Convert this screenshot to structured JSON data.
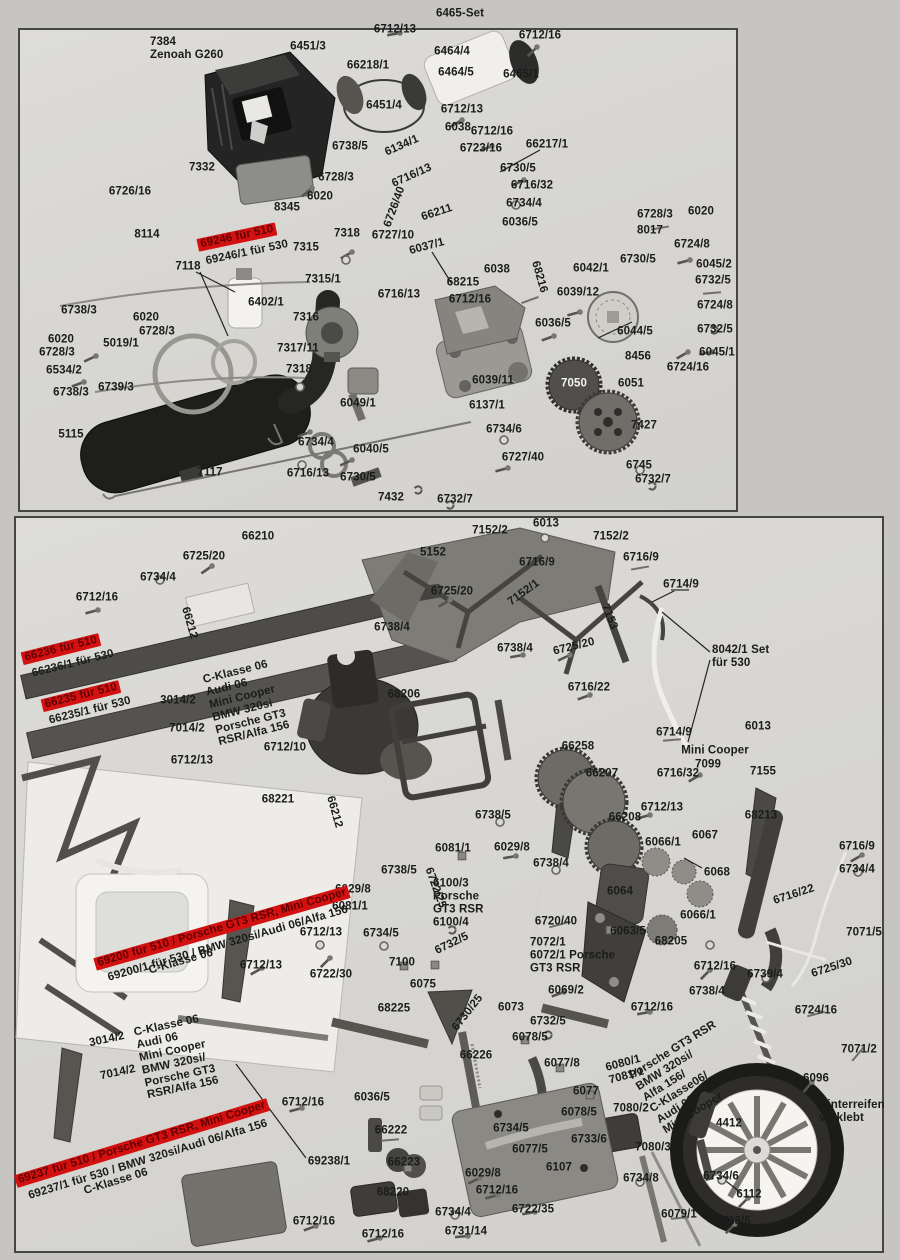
{
  "colors": {
    "highlight_band": "#d41111",
    "ink": "#1b1b1b",
    "panel_bg": "#d7d6d2"
  },
  "panels": [
    {
      "id": "engine-assembly",
      "note": "engine / exhaust / clutch exploded view"
    },
    {
      "id": "chassis-assembly",
      "note": "chassis / drivetrain / wheel exploded view"
    }
  ],
  "labels": [
    {
      "t": "6465-Set",
      "x": 460,
      "y": 14
    },
    {
      "t": "6712/13",
      "x": 395,
      "y": 30
    },
    {
      "t": "6712/16",
      "x": 540,
      "y": 36
    },
    {
      "t": "7384\nZenoah G260",
      "x": 150,
      "y": 49,
      "ta": 1
    },
    {
      "t": "6451/3",
      "x": 308,
      "y": 47
    },
    {
      "t": "6464/4",
      "x": 452,
      "y": 52
    },
    {
      "t": "66218/1",
      "x": 368,
      "y": 66
    },
    {
      "t": "6464/5",
      "x": 456,
      "y": 73
    },
    {
      "t": "6465/1",
      "x": 521,
      "y": 75
    },
    {
      "t": "6451/4",
      "x": 384,
      "y": 106
    },
    {
      "t": "6712/13",
      "x": 462,
      "y": 110
    },
    {
      "t": "6038",
      "x": 458,
      "y": 128
    },
    {
      "t": "6712/16",
      "x": 492,
      "y": 132
    },
    {
      "t": "6723/16",
      "x": 481,
      "y": 149
    },
    {
      "t": "66217/1",
      "x": 547,
      "y": 145
    },
    {
      "t": "6738/5",
      "x": 350,
      "y": 147
    },
    {
      "t": "6134/1",
      "x": 402,
      "y": 146,
      "r": -24
    },
    {
      "t": "6730/5",
      "x": 518,
      "y": 169
    },
    {
      "t": "6716/32",
      "x": 532,
      "y": 186
    },
    {
      "t": "6716/13",
      "x": 412,
      "y": 176,
      "r": -24
    },
    {
      "t": "6726/16",
      "x": 130,
      "y": 192
    },
    {
      "t": "7332",
      "x": 202,
      "y": 168
    },
    {
      "t": "6728/3",
      "x": 336,
      "y": 178
    },
    {
      "t": "6020",
      "x": 320,
      "y": 197
    },
    {
      "t": "6734/4",
      "x": 524,
      "y": 204
    },
    {
      "t": "8345",
      "x": 287,
      "y": 208
    },
    {
      "t": "6726/40",
      "x": 395,
      "y": 207,
      "r": -70
    },
    {
      "t": "66211",
      "x": 437,
      "y": 213,
      "r": -18
    },
    {
      "t": "6036/5",
      "x": 520,
      "y": 223
    },
    {
      "t": "6728/3",
      "x": 655,
      "y": 215
    },
    {
      "t": "6020",
      "x": 701,
      "y": 212
    },
    {
      "t": "8114",
      "x": 147,
      "y": 235
    },
    {
      "t": "8017",
      "x": 650,
      "y": 231
    },
    {
      "t": "6727/10",
      "x": 393,
      "y": 236
    },
    {
      "t": "6037/1",
      "x": 427,
      "y": 247,
      "r": -15
    },
    {
      "t": "6724/8",
      "x": 692,
      "y": 245
    },
    {
      "t": "7318",
      "x": 347,
      "y": 234
    },
    {
      "t": "7315",
      "x": 306,
      "y": 248
    },
    {
      "t": "69246 für 510",
      "x": 237,
      "y": 237,
      "r": -12,
      "hl": 1
    },
    {
      "t": "69246/1 für 530",
      "x": 247,
      "y": 253,
      "r": -12
    },
    {
      "t": "6730/5",
      "x": 638,
      "y": 260
    },
    {
      "t": "6045/2",
      "x": 714,
      "y": 265
    },
    {
      "t": "6042/1",
      "x": 591,
      "y": 269
    },
    {
      "t": "6732/5",
      "x": 713,
      "y": 281
    },
    {
      "t": "7315/1",
      "x": 323,
      "y": 280
    },
    {
      "t": "6038",
      "x": 497,
      "y": 270
    },
    {
      "t": "68215",
      "x": 463,
      "y": 283
    },
    {
      "t": "6716/13",
      "x": 399,
      "y": 295
    },
    {
      "t": "6712/16",
      "x": 470,
      "y": 300
    },
    {
      "t": "68216",
      "x": 539,
      "y": 277,
      "r": 74
    },
    {
      "t": "6039/12",
      "x": 578,
      "y": 293
    },
    {
      "t": "6724/8",
      "x": 715,
      "y": 306
    },
    {
      "t": "7118",
      "x": 188,
      "y": 267
    },
    {
      "t": "6402/1",
      "x": 266,
      "y": 303
    },
    {
      "t": "7316",
      "x": 306,
      "y": 318
    },
    {
      "t": "6020",
      "x": 146,
      "y": 318
    },
    {
      "t": "6728/3",
      "x": 157,
      "y": 332
    },
    {
      "t": "6738/3",
      "x": 79,
      "y": 311
    },
    {
      "t": "5019/1",
      "x": 121,
      "y": 344
    },
    {
      "t": "6036/5",
      "x": 553,
      "y": 324
    },
    {
      "t": "6732/5",
      "x": 715,
      "y": 330
    },
    {
      "t": "6020",
      "x": 61,
      "y": 340
    },
    {
      "t": "6728/3",
      "x": 57,
      "y": 353
    },
    {
      "t": "7317/11",
      "x": 298,
      "y": 349
    },
    {
      "t": "6044/5",
      "x": 635,
      "y": 332
    },
    {
      "t": "6534/2",
      "x": 64,
      "y": 371
    },
    {
      "t": "8456",
      "x": 638,
      "y": 357
    },
    {
      "t": "6045/1",
      "x": 717,
      "y": 353
    },
    {
      "t": "6739/3",
      "x": 116,
      "y": 388
    },
    {
      "t": "6738/3",
      "x": 71,
      "y": 393
    },
    {
      "t": "7318",
      "x": 299,
      "y": 370
    },
    {
      "t": "6724/16",
      "x": 688,
      "y": 368
    },
    {
      "t": "6039/11",
      "x": 493,
      "y": 381
    },
    {
      "t": "7050",
      "x": 574,
      "y": 384,
      "w": 1
    },
    {
      "t": "6051",
      "x": 631,
      "y": 384
    },
    {
      "t": "6049/1",
      "x": 358,
      "y": 404
    },
    {
      "t": "6137/1",
      "x": 487,
      "y": 406
    },
    {
      "t": "7427",
      "x": 644,
      "y": 426
    },
    {
      "t": "5115",
      "x": 71,
      "y": 435
    },
    {
      "t": "6734/4",
      "x": 316,
      "y": 443
    },
    {
      "t": "6734/6",
      "x": 504,
      "y": 430
    },
    {
      "t": "6040/5",
      "x": 371,
      "y": 450
    },
    {
      "t": "6727/40",
      "x": 523,
      "y": 458
    },
    {
      "t": "6716/13",
      "x": 308,
      "y": 474
    },
    {
      "t": "6730/5",
      "x": 358,
      "y": 478
    },
    {
      "t": "7117",
      "x": 210,
      "y": 473
    },
    {
      "t": "6745",
      "x": 639,
      "y": 466
    },
    {
      "t": "7432",
      "x": 391,
      "y": 498
    },
    {
      "t": "6732/7",
      "x": 455,
      "y": 500
    },
    {
      "t": "6732/7",
      "x": 653,
      "y": 480
    },
    {
      "t": "66210",
      "x": 258,
      "y": 537
    },
    {
      "t": "6725/20",
      "x": 204,
      "y": 557
    },
    {
      "t": "7152/2",
      "x": 490,
      "y": 531
    },
    {
      "t": "6013",
      "x": 546,
      "y": 524
    },
    {
      "t": "7152/2",
      "x": 611,
      "y": 537
    },
    {
      "t": "6734/4",
      "x": 158,
      "y": 578
    },
    {
      "t": "5152",
      "x": 433,
      "y": 553
    },
    {
      "t": "6716/9",
      "x": 537,
      "y": 563
    },
    {
      "t": "6716/9",
      "x": 641,
      "y": 558
    },
    {
      "t": "6712/16",
      "x": 97,
      "y": 598
    },
    {
      "t": "66212",
      "x": 189,
      "y": 623,
      "r": 74
    },
    {
      "t": "6725/20",
      "x": 452,
      "y": 592
    },
    {
      "t": "7152/1",
      "x": 524,
      "y": 593,
      "r": -36
    },
    {
      "t": "6714/9",
      "x": 681,
      "y": 585
    },
    {
      "t": "7153",
      "x": 609,
      "y": 617,
      "r": 68
    },
    {
      "t": "6738/4",
      "x": 392,
      "y": 628
    },
    {
      "t": "66236 für 510",
      "x": 61,
      "y": 649,
      "r": -14,
      "hl": 1
    },
    {
      "t": "66236/1 für 530",
      "x": 73,
      "y": 664,
      "r": -14
    },
    {
      "t": "6738/4",
      "x": 515,
      "y": 649
    },
    {
      "t": "6725/20",
      "x": 574,
      "y": 647,
      "r": -14
    },
    {
      "t": "8042/1 Set\nfür 530",
      "x": 712,
      "y": 657,
      "ta": 1
    },
    {
      "t": "C-Klasse 06\nAudi 06\nMini Cooper\nBMW 320si\nPorsche GT3\nRSR/Alfa 156",
      "x": 210,
      "y": 703,
      "r": -14,
      "ta": 1
    },
    {
      "t": "66235 für 510",
      "x": 81,
      "y": 696,
      "r": -14,
      "hl": 1
    },
    {
      "t": "66235/1 für 530",
      "x": 90,
      "y": 711,
      "r": -14
    },
    {
      "t": "3014/2",
      "x": 178,
      "y": 701
    },
    {
      "t": "68206",
      "x": 404,
      "y": 695
    },
    {
      "t": "6716/22",
      "x": 589,
      "y": 688
    },
    {
      "t": "7014/2",
      "x": 187,
      "y": 729
    },
    {
      "t": "6714/9",
      "x": 674,
      "y": 733
    },
    {
      "t": "6013",
      "x": 758,
      "y": 727
    },
    {
      "t": "6712/13",
      "x": 192,
      "y": 761
    },
    {
      "t": "6712/10",
      "x": 285,
      "y": 748
    },
    {
      "t": "66258",
      "x": 578,
      "y": 747
    },
    {
      "t": "Mini Cooper",
      "x": 715,
      "y": 751
    },
    {
      "t": "7099",
      "x": 708,
      "y": 765
    },
    {
      "t": "66207",
      "x": 602,
      "y": 774
    },
    {
      "t": "6716/32",
      "x": 678,
      "y": 774
    },
    {
      "t": "7155",
      "x": 763,
      "y": 772
    },
    {
      "t": "68221",
      "x": 278,
      "y": 800
    },
    {
      "t": "66212",
      "x": 334,
      "y": 812,
      "r": 74
    },
    {
      "t": "6712/13",
      "x": 662,
      "y": 808
    },
    {
      "t": "66208",
      "x": 625,
      "y": 818
    },
    {
      "t": "68213",
      "x": 761,
      "y": 816
    },
    {
      "t": "6738/5",
      "x": 493,
      "y": 816
    },
    {
      "t": "6067",
      "x": 705,
      "y": 836
    },
    {
      "t": "6066/1",
      "x": 663,
      "y": 843
    },
    {
      "t": "6716/9",
      "x": 857,
      "y": 847
    },
    {
      "t": "6081/1",
      "x": 453,
      "y": 849
    },
    {
      "t": "6029/8",
      "x": 512,
      "y": 848
    },
    {
      "t": "6738/4",
      "x": 551,
      "y": 864
    },
    {
      "t": "6734/4",
      "x": 857,
      "y": 870
    },
    {
      "t": "6068",
      "x": 717,
      "y": 873
    },
    {
      "t": "6738/5",
      "x": 399,
      "y": 871
    },
    {
      "t": "6722/25",
      "x": 435,
      "y": 888,
      "r": 70
    },
    {
      "t": "6100/3\nPorsche\nGT3 RSR\n6100/4",
      "x": 433,
      "y": 903,
      "ta": 1
    },
    {
      "t": "6064",
      "x": 620,
      "y": 892
    },
    {
      "t": "6066/1",
      "x": 698,
      "y": 916
    },
    {
      "t": "6716/22",
      "x": 794,
      "y": 895,
      "r": -18
    },
    {
      "t": "6063/5",
      "x": 628,
      "y": 932
    },
    {
      "t": "7071/5",
      "x": 864,
      "y": 933
    },
    {
      "t": "6720/40",
      "x": 556,
      "y": 922
    },
    {
      "t": "68205",
      "x": 671,
      "y": 942
    },
    {
      "t": "6029/8",
      "x": 353,
      "y": 890
    },
    {
      "t": "6081/1",
      "x": 350,
      "y": 907
    },
    {
      "t": "69200   für 510 / Porsche GT3 RSR, Mini Cooper",
      "x": 222,
      "y": 928,
      "r": -16,
      "hl": 1
    },
    {
      "t": "69200/1 für 530 / BMW 320si/Audi 06/Alfa 156",
      "x": 228,
      "y": 944,
      "r": -16
    },
    {
      "t": "C-Klasse 06",
      "x": 181,
      "y": 962,
      "r": -16
    },
    {
      "t": "6712/13",
      "x": 321,
      "y": 933
    },
    {
      "t": "6734/5",
      "x": 381,
      "y": 934
    },
    {
      "t": "6732/5",
      "x": 452,
      "y": 944,
      "r": -26
    },
    {
      "t": "7072/1\n6072/1 Porsche\nGT3 RSR",
      "x": 530,
      "y": 956,
      "ta": 1
    },
    {
      "t": "6712/16",
      "x": 715,
      "y": 967
    },
    {
      "t": "6739/4",
      "x": 765,
      "y": 975
    },
    {
      "t": "6722/30",
      "x": 331,
      "y": 975
    },
    {
      "t": "7100",
      "x": 402,
      "y": 963
    },
    {
      "t": "6725/30",
      "x": 832,
      "y": 968,
      "r": -18
    },
    {
      "t": "6712/13",
      "x": 261,
      "y": 966
    },
    {
      "t": "6075",
      "x": 423,
      "y": 985
    },
    {
      "t": "6738/4",
      "x": 707,
      "y": 992
    },
    {
      "t": "6069/2",
      "x": 566,
      "y": 991
    },
    {
      "t": "6712/16",
      "x": 652,
      "y": 1008
    },
    {
      "t": "68225",
      "x": 394,
      "y": 1009
    },
    {
      "t": "6730/25",
      "x": 468,
      "y": 1013,
      "r": -52
    },
    {
      "t": "6073",
      "x": 511,
      "y": 1008
    },
    {
      "t": "6732/5",
      "x": 548,
      "y": 1022
    },
    {
      "t": "6724/16",
      "x": 816,
      "y": 1011
    },
    {
      "t": "6078/5",
      "x": 530,
      "y": 1038
    },
    {
      "t": "66226",
      "x": 476,
      "y": 1056
    },
    {
      "t": "6077/8",
      "x": 562,
      "y": 1064
    },
    {
      "t": "6080/1\n7081/1",
      "x": 607,
      "y": 1070,
      "r": -15,
      "ta": 1
    },
    {
      "t": "Porsche GT3 RSR\nBMW 320si/\nAlfa 156/\nC-Klasse06/\nAudi 06/\nMini Cooper",
      "x": 640,
      "y": 1078,
      "r": -32,
      "ta": 1
    },
    {
      "t": "6096",
      "x": 816,
      "y": 1079
    },
    {
      "t": "7071/2",
      "x": 859,
      "y": 1050
    },
    {
      "t": "6077",
      "x": 586,
      "y": 1092
    },
    {
      "t": "Hinterreifen\nverklebt",
      "x": 819,
      "y": 1112,
      "ta": 1
    },
    {
      "t": "7080/2",
      "x": 631,
      "y": 1109
    },
    {
      "t": "6078/5",
      "x": 579,
      "y": 1113
    },
    {
      "t": "3014/2",
      "x": 107,
      "y": 1040,
      "r": -12
    },
    {
      "t": "C-Klasse 06\nAudi 06\nMini Cooper\nBMW 320si/\nPorsche GT3\nRSR/Alfa 156",
      "x": 140,
      "y": 1057,
      "r": -12,
      "ta": 1
    },
    {
      "t": "7014/2",
      "x": 118,
      "y": 1073,
      "r": -12
    },
    {
      "t": "6036/5",
      "x": 372,
      "y": 1098
    },
    {
      "t": "6712/16",
      "x": 303,
      "y": 1103
    },
    {
      "t": "4412",
      "x": 729,
      "y": 1124
    },
    {
      "t": "66222",
      "x": 391,
      "y": 1131
    },
    {
      "t": "6734/5",
      "x": 511,
      "y": 1129
    },
    {
      "t": "6733/6",
      "x": 589,
      "y": 1140
    },
    {
      "t": "6077/5",
      "x": 530,
      "y": 1150
    },
    {
      "t": "7080/3",
      "x": 653,
      "y": 1148
    },
    {
      "t": "69237   für 510 / Porsche GT3 RSR, Mini Cooper",
      "x": 142,
      "y": 1143,
      "r": -17,
      "hl": 1
    },
    {
      "t": "69237/1 für 530 / BMW 320si/Audi 06/Alfa 156",
      "x": 148,
      "y": 1160,
      "r": -17
    },
    {
      "t": "C-Klasse 06",
      "x": 116,
      "y": 1182,
      "r": -17
    },
    {
      "t": "66223",
      "x": 404,
      "y": 1163
    },
    {
      "t": "6107",
      "x": 559,
      "y": 1168
    },
    {
      "t": "69238/1",
      "x": 329,
      "y": 1162
    },
    {
      "t": "6029/8",
      "x": 483,
      "y": 1174
    },
    {
      "t": "6734/8",
      "x": 641,
      "y": 1179
    },
    {
      "t": "6734/6",
      "x": 721,
      "y": 1177
    },
    {
      "t": "68220",
      "x": 393,
      "y": 1193
    },
    {
      "t": "6712/16",
      "x": 497,
      "y": 1191
    },
    {
      "t": "6112",
      "x": 749,
      "y": 1195
    },
    {
      "t": "6722/35",
      "x": 533,
      "y": 1210
    },
    {
      "t": "6734/4",
      "x": 453,
      "y": 1213
    },
    {
      "t": "6079/1",
      "x": 679,
      "y": 1215
    },
    {
      "t": "6712/16",
      "x": 314,
      "y": 1222
    },
    {
      "t": "6731/14",
      "x": 466,
      "y": 1232
    },
    {
      "t": "6738/6",
      "x": 733,
      "y": 1222
    },
    {
      "t": "6712/16",
      "x": 383,
      "y": 1235
    }
  ]
}
